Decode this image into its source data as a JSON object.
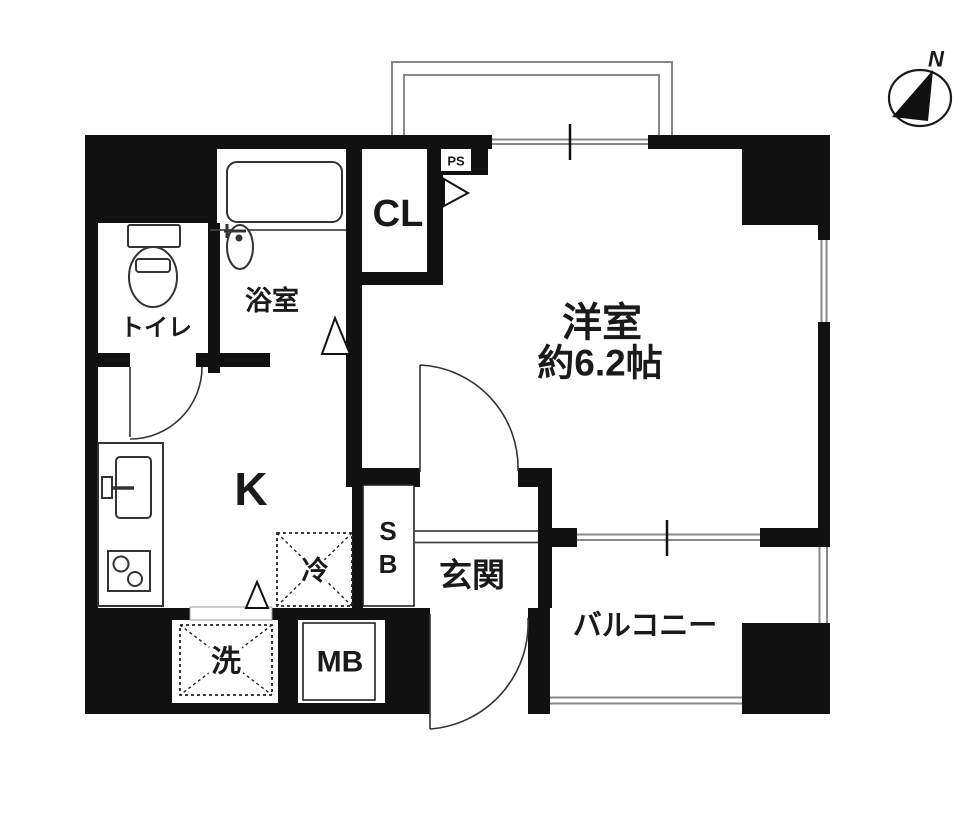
{
  "title": "apartment-floor-plan",
  "colors": {
    "wall": "#111111",
    "background": "#ffffff",
    "thin_line": "#888888"
  },
  "compass": {
    "north_label": "N"
  },
  "rooms": {
    "toilet": "トイレ",
    "bath": "浴室",
    "closet": "CL",
    "pipe_space": "PS",
    "western_room_name": "洋室",
    "western_room_size": "約6.2帖",
    "kitchen": "K",
    "refrigerator_space": "冷",
    "shoe_box_top": "S",
    "shoe_box_bottom": "B",
    "entrance": "玄関",
    "balcony": "バルコニー",
    "washer_space": "洗",
    "meter_box": "MB"
  }
}
